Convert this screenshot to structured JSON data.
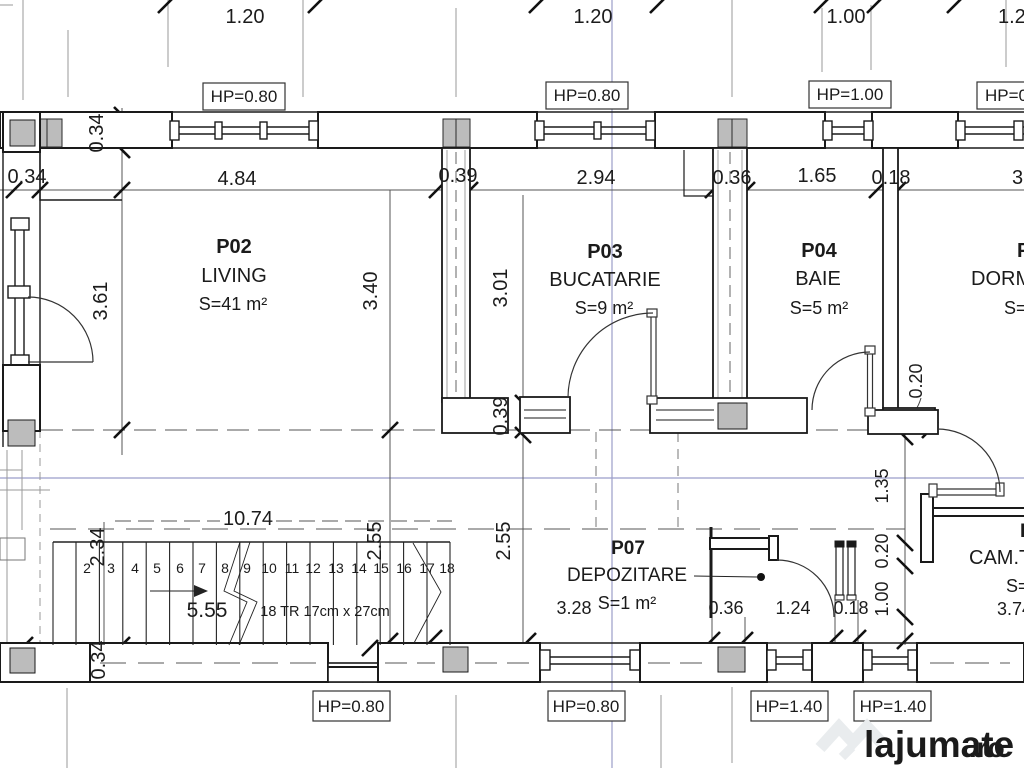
{
  "drawing": {
    "type": "architectural-floor-plan",
    "rooms": [
      {
        "code": "P02",
        "name": "LIVING",
        "area": "S=41 m²"
      },
      {
        "code": "P03",
        "name": "BUCATARIE",
        "area": "S=9 m²"
      },
      {
        "code": "P04",
        "name": "BAIE",
        "area": "S=5 m²"
      },
      {
        "code": "P07",
        "name": "DEPOZITARE",
        "area": "S=1 m²"
      },
      {
        "code": "P",
        "name": "DORM",
        "area": "S="
      },
      {
        "code": "P",
        "name": "CAM.T",
        "area": "S="
      }
    ],
    "stair_note": "18 TR 17cm x 27cm",
    "watermark": {
      "name": "lajumate",
      "tld": ".ro",
      "logo_color": "#e9ecee",
      "tld_color": "#c9e9d4"
    }
  },
  "labels": [
    {
      "id": "dim-top-1",
      "text": "1.20",
      "x": 245,
      "y": 23,
      "s": 20
    },
    {
      "id": "dim-top-2",
      "text": "1.20",
      "x": 593,
      "y": 23,
      "s": 20
    },
    {
      "id": "dim-top-3",
      "text": "1.00",
      "x": 846,
      "y": 23,
      "s": 20
    },
    {
      "id": "dim-top-4",
      "text": "1.2",
      "x": 998,
      "y": 23,
      "s": 20,
      "a": "start"
    },
    {
      "id": "dim-wall-034",
      "text": "0.34",
      "x": 27,
      "y": 183,
      "s": 20
    },
    {
      "id": "dim-wall-484",
      "text": "4.84",
      "x": 237,
      "y": 185,
      "s": 20
    },
    {
      "id": "dim-wall-039",
      "text": "0.39",
      "x": 458,
      "y": 182,
      "s": 20
    },
    {
      "id": "dim-wall-294",
      "text": "2.94",
      "x": 596,
      "y": 184,
      "s": 20
    },
    {
      "id": "dim-wall-036",
      "text": "0.36",
      "x": 732,
      "y": 184,
      "s": 20
    },
    {
      "id": "dim-wall-165",
      "text": "1.65",
      "x": 817,
      "y": 182,
      "s": 20
    },
    {
      "id": "dim-wall-018",
      "text": "0.18",
      "x": 891,
      "y": 184,
      "s": 20
    },
    {
      "id": "dim-wall-3",
      "text": "3.",
      "x": 1012,
      "y": 184,
      "s": 20,
      "a": "start"
    },
    {
      "id": "dim-034-corner",
      "text": "0.34",
      "x": 103,
      "y": 133,
      "s": 20,
      "rot": -90
    },
    {
      "id": "dim-361",
      "text": "3.61",
      "x": 107,
      "y": 301,
      "s": 20,
      "rot": -90
    },
    {
      "id": "dim-340",
      "text": "3.40",
      "x": 377,
      "y": 291,
      "s": 20,
      "rot": -90
    },
    {
      "id": "dim-301",
      "text": "3.01",
      "x": 507,
      "y": 288,
      "s": 20,
      "rot": -90
    },
    {
      "id": "dim-039-v",
      "text": "0.39",
      "x": 507,
      "y": 416,
      "s": 20,
      "rot": -90
    },
    {
      "id": "dim-255-a",
      "text": "2.55",
      "x": 381,
      "y": 541,
      "s": 20,
      "rot": -90
    },
    {
      "id": "dim-255-b",
      "text": "2.55",
      "x": 510,
      "y": 541,
      "s": 20,
      "rot": -90
    },
    {
      "id": "dim-234",
      "text": "2.34",
      "x": 104,
      "y": 547,
      "s": 20,
      "rot": -90
    },
    {
      "id": "dim-034-bl",
      "text": "0.34",
      "x": 105,
      "y": 660,
      "s": 20,
      "rot": -90
    },
    {
      "id": "dim-1074",
      "text": "10.74",
      "x": 248,
      "y": 525,
      "s": 20
    },
    {
      "id": "dim-555",
      "text": "5.55",
      "x": 207,
      "y": 617,
      "s": 21
    },
    {
      "id": "stair-note",
      "text": "18 TR 17cm x 27cm",
      "x": 325,
      "y": 616,
      "s": 14.5
    },
    {
      "id": "dim-328",
      "text": "3.28",
      "x": 574,
      "y": 614,
      "s": 18
    },
    {
      "id": "dim-036-b",
      "text": "0.36",
      "x": 726,
      "y": 614,
      "s": 18
    },
    {
      "id": "dim-124",
      "text": "1.24",
      "x": 793,
      "y": 614,
      "s": 18
    },
    {
      "id": "dim-018-b",
      "text": "0.18",
      "x": 851,
      "y": 614,
      "s": 18
    },
    {
      "id": "dim-135",
      "text": "1.35",
      "x": 888,
      "y": 486,
      "s": 18,
      "rot": -90
    },
    {
      "id": "dim-020-a",
      "text": "0.20",
      "x": 888,
      "y": 551,
      "s": 18,
      "rot": -90
    },
    {
      "id": "dim-100",
      "text": "1.00",
      "x": 888,
      "y": 599,
      "s": 18,
      "rot": -90
    },
    {
      "id": "dim-020-baie",
      "text": "0.20",
      "x": 922,
      "y": 381,
      "s": 18,
      "rot": -90
    },
    {
      "id": "dim-374",
      "text": "3.74",
      "x": 997,
      "y": 615,
      "s": 18,
      "a": "start"
    },
    {
      "id": "room-p02-code",
      "text": "P02",
      "x": 234,
      "y": 253,
      "s": 20,
      "w": "bold"
    },
    {
      "id": "room-p02-name",
      "text": "LIVING",
      "x": 234,
      "y": 282,
      "s": 20
    },
    {
      "id": "room-p02-area",
      "text": "S=41 m²",
      "x": 233,
      "y": 310,
      "s": 18
    },
    {
      "id": "room-p03-code",
      "text": "P03",
      "x": 605,
      "y": 258,
      "s": 20,
      "w": "bold"
    },
    {
      "id": "room-p03-name",
      "text": "BUCATARIE",
      "x": 605,
      "y": 286,
      "s": 20
    },
    {
      "id": "room-p03-area",
      "text": "S=9 m²",
      "x": 604,
      "y": 314,
      "s": 18
    },
    {
      "id": "room-p04-code",
      "text": "P04",
      "x": 819,
      "y": 257,
      "s": 20,
      "w": "bold"
    },
    {
      "id": "room-p04-name",
      "text": "BAIE",
      "x": 818,
      "y": 285,
      "s": 20
    },
    {
      "id": "room-p04-area",
      "text": "S=5 m²",
      "x": 819,
      "y": 314,
      "s": 18
    },
    {
      "id": "room-p05-code",
      "text": "P",
      "x": 1017,
      "y": 257,
      "s": 20,
      "w": "bold",
      "a": "start"
    },
    {
      "id": "room-p05-name",
      "text": "DORM",
      "x": 971,
      "y": 285,
      "s": 20,
      "a": "start"
    },
    {
      "id": "room-p05-area",
      "text": "S=",
      "x": 1004,
      "y": 314,
      "s": 18,
      "a": "start"
    },
    {
      "id": "room-p07-code",
      "text": "P07",
      "x": 628,
      "y": 554,
      "s": 19,
      "w": "bold"
    },
    {
      "id": "room-p07-name",
      "text": "DEPOZITARE",
      "x": 627,
      "y": 581,
      "s": 19
    },
    {
      "id": "room-p07-area",
      "text": "S=1 m²",
      "x": 627,
      "y": 609,
      "s": 18
    },
    {
      "id": "room-camt-code",
      "text": "P",
      "x": 1020,
      "y": 537,
      "s": 19,
      "w": "bold",
      "a": "start"
    },
    {
      "id": "room-camt-name",
      "text": "CAM.T",
      "x": 969,
      "y": 564,
      "s": 20,
      "a": "start"
    },
    {
      "id": "room-camt-area",
      "text": "S=",
      "x": 1006,
      "y": 592,
      "s": 18,
      "a": "start"
    },
    {
      "id": "hp-top-1",
      "text": "HP=0.80",
      "x": 244,
      "y": 102,
      "s": 17
    },
    {
      "id": "hp-top-2",
      "text": "HP=0.80",
      "x": 587,
      "y": 101,
      "s": 17
    },
    {
      "id": "hp-top-3",
      "text": "HP=1.00",
      "x": 850,
      "y": 100,
      "s": 17
    },
    {
      "id": "hp-top-4",
      "text": "HP=0",
      "x": 985,
      "y": 101,
      "s": 17,
      "a": "start"
    },
    {
      "id": "hp-bottom-1",
      "text": "HP=0.80",
      "x": 351,
      "y": 712,
      "s": 17
    },
    {
      "id": "hp-bottom-2",
      "text": "HP=0.80",
      "x": 586,
      "y": 712,
      "s": 17
    },
    {
      "id": "hp-bottom-3",
      "text": "HP=1.40",
      "x": 789,
      "y": 712,
      "s": 17
    },
    {
      "id": "hp-bottom-4",
      "text": "HP=1.40",
      "x": 893,
      "y": 712,
      "s": 17
    },
    {
      "id": "stair-step-2",
      "text": "2",
      "x": 87,
      "y": 573,
      "s": 14
    },
    {
      "id": "stair-step-3",
      "text": "3",
      "x": 111,
      "y": 573,
      "s": 14
    },
    {
      "id": "stair-step-4",
      "text": "4",
      "x": 135,
      "y": 573,
      "s": 14
    },
    {
      "id": "stair-step-5",
      "text": "5",
      "x": 157,
      "y": 573,
      "s": 14
    },
    {
      "id": "stair-step-6",
      "text": "6",
      "x": 180,
      "y": 573,
      "s": 14
    },
    {
      "id": "stair-step-7",
      "text": "7",
      "x": 202,
      "y": 573,
      "s": 14
    },
    {
      "id": "stair-step-8",
      "text": "8",
      "x": 225,
      "y": 573,
      "s": 14
    },
    {
      "id": "stair-step-9",
      "text": "9",
      "x": 247,
      "y": 573,
      "s": 14
    },
    {
      "id": "stair-step-10",
      "text": "10",
      "x": 269,
      "y": 573,
      "s": 14
    },
    {
      "id": "stair-step-11",
      "text": "11",
      "x": 292,
      "y": 573,
      "s": 14
    },
    {
      "id": "stair-step-12",
      "text": "12",
      "x": 313,
      "y": 573,
      "s": 14
    },
    {
      "id": "stair-step-13",
      "text": "13",
      "x": 336,
      "y": 573,
      "s": 14
    },
    {
      "id": "stair-step-14",
      "text": "14",
      "x": 359,
      "y": 573,
      "s": 14
    },
    {
      "id": "stair-step-15",
      "text": "15",
      "x": 381,
      "y": 573,
      "s": 14
    },
    {
      "id": "stair-step-16",
      "text": "16",
      "x": 404,
      "y": 573,
      "s": 14
    },
    {
      "id": "stair-step-17",
      "text": "17",
      "x": 427,
      "y": 573,
      "s": 14
    },
    {
      "id": "stair-step-18",
      "text": "18",
      "x": 447,
      "y": 573,
      "s": 14
    },
    {
      "id": "watermark-name",
      "text": "lajumate",
      "x": 864,
      "y": 757,
      "s": 37,
      "w": "bold",
      "a": "start",
      "fill": "#e9ecee"
    },
    {
      "id": "watermark-tld",
      "text": ".ro",
      "x": 969,
      "y": 757,
      "s": 28,
      "w": "bold",
      "a": "start",
      "fill": "#c9e9d4"
    }
  ]
}
